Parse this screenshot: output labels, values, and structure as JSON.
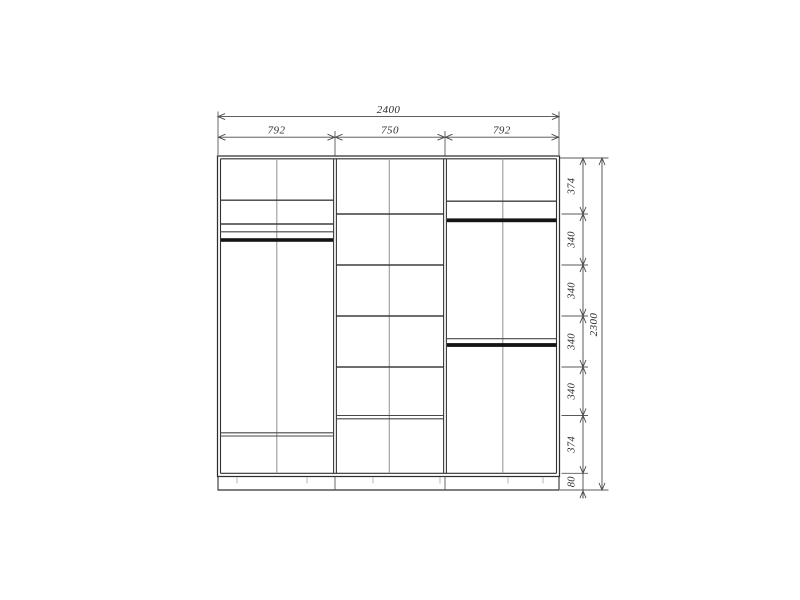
{
  "dimensions": {
    "total_width": "2400",
    "section_widths": [
      "792",
      "750",
      "792"
    ],
    "height_segments": [
      "374",
      "340",
      "340",
      "340",
      "340",
      "374"
    ],
    "plinth_height": "80",
    "total_height": "2300"
  },
  "colors": {
    "background": "#ffffff",
    "carcass_line": "#303030",
    "shelf_line": "#3d3d3d",
    "center_divider_line": "#9a9a9a",
    "hanging_rod": "#141414",
    "dimension_line": "#4a4a4a",
    "dimension_text": "#2e2e2e"
  }
}
